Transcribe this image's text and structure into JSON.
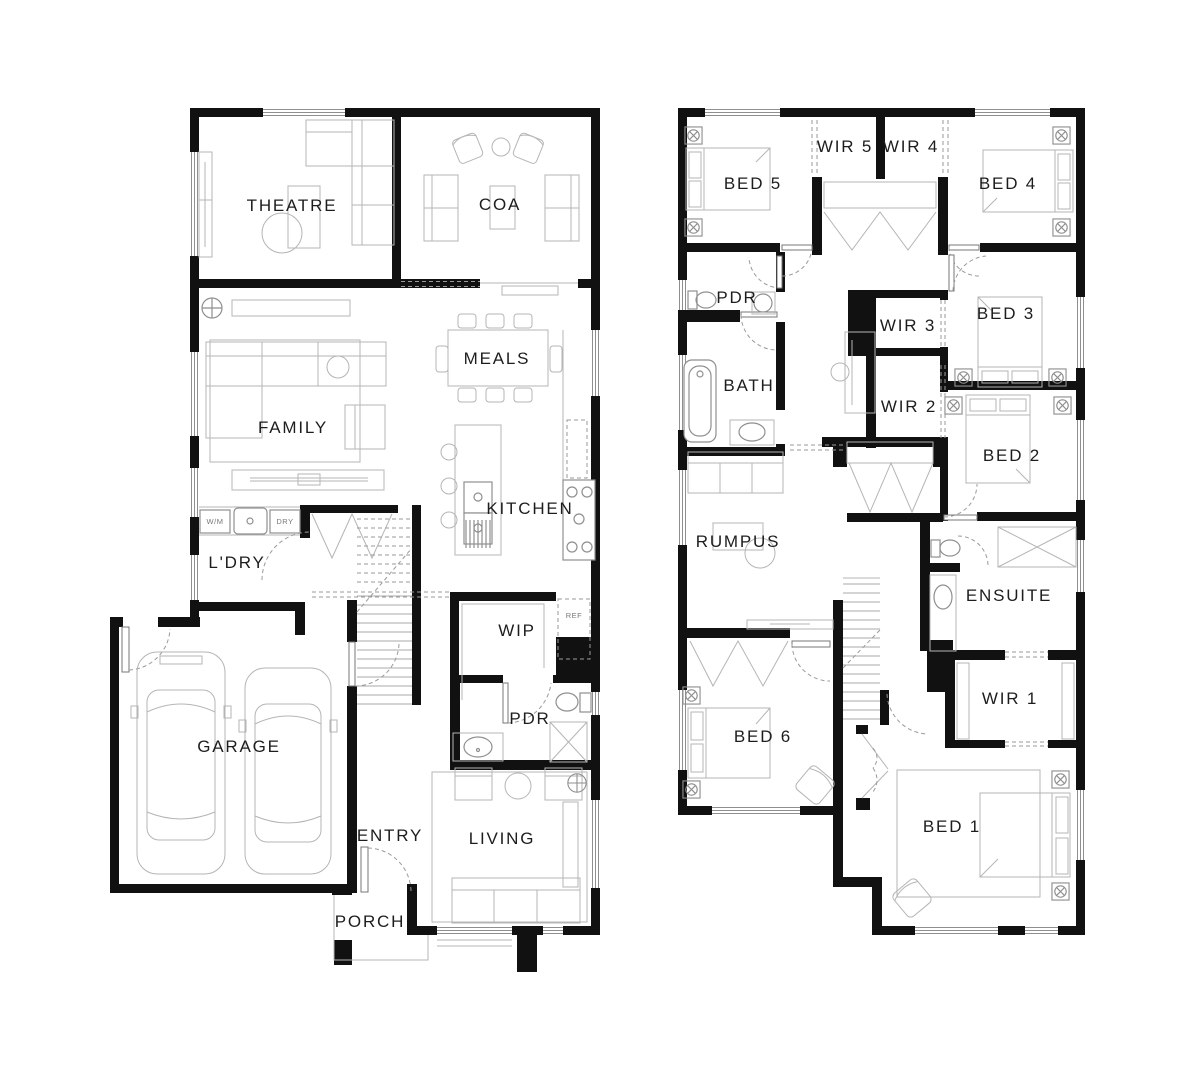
{
  "colors": {
    "background": "#ffffff",
    "wall": "#111111",
    "furniture_line": "#b5b5b5",
    "fixture_line": "#8f8f8f",
    "door_swing": "#9a9a9a",
    "label": "#1d1d1d",
    "label_small": "#777777"
  },
  "ground_floor": {
    "theatre": "THEATRE",
    "coa": "COA",
    "meals": "MEALS",
    "family": "FAMILY",
    "kitchen": "KITCHEN",
    "laundry": "L'DRY",
    "wip": "WIP",
    "powder": "PDR",
    "garage": "GARAGE",
    "entry": "ENTRY",
    "living": "LIVING",
    "porch": "PORCH",
    "washing_machine": "W/M",
    "dryer": "DRY",
    "fridge": "REF"
  },
  "first_floor": {
    "bed5": "BED 5",
    "wir5": "WIR 5",
    "wir4": "WIR 4",
    "bed4": "BED 4",
    "powder": "PDR",
    "wir3": "WIR 3",
    "bed3": "BED 3",
    "bath": "BATH",
    "wir2": "WIR 2",
    "bed2": "BED 2",
    "rumpus": "RUMPUS",
    "ensuite": "ENSUITE",
    "wir1": "WIR 1",
    "bed6": "BED 6",
    "bed1": "BED 1"
  }
}
